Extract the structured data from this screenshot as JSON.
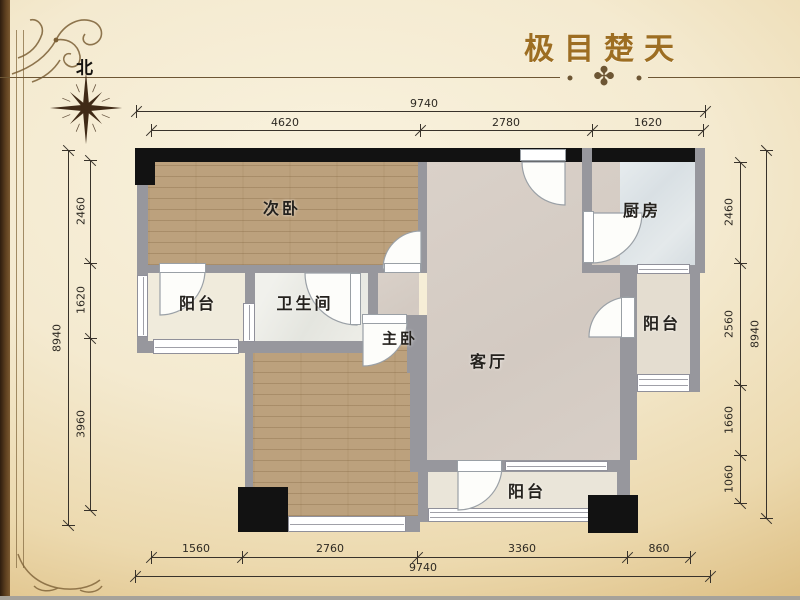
{
  "title": "极目楚天",
  "compass": {
    "north": "北"
  },
  "rooms": {
    "secondary_bedroom": "次卧",
    "kitchen": "厨房",
    "balcony_left": "阳台",
    "bathroom": "卫生间",
    "master_bedroom": "主卧",
    "living_room": "客厅",
    "balcony_right": "阳台",
    "balcony_bottom": "阳台"
  },
  "dimensions": {
    "top": {
      "total": "9740",
      "segments": [
        "4620",
        "2780",
        "1620"
      ]
    },
    "bottom": {
      "total": "9740",
      "segments": [
        "1560",
        "2760",
        "3360",
        "860"
      ]
    },
    "left": {
      "total": "8940",
      "segments": [
        "2460",
        "1620",
        "3960"
      ]
    },
    "right": {
      "total": "8940",
      "segments": [
        "2460",
        "2560",
        "1660",
        "1060"
      ]
    }
  },
  "colors": {
    "title": "#9d6e22",
    "wall": "#97979d",
    "column": "#121212",
    "wood_floor": "#bca17d",
    "divider_line": "#6d5634"
  },
  "ornaments": {
    "divider_glyph": "✤"
  }
}
